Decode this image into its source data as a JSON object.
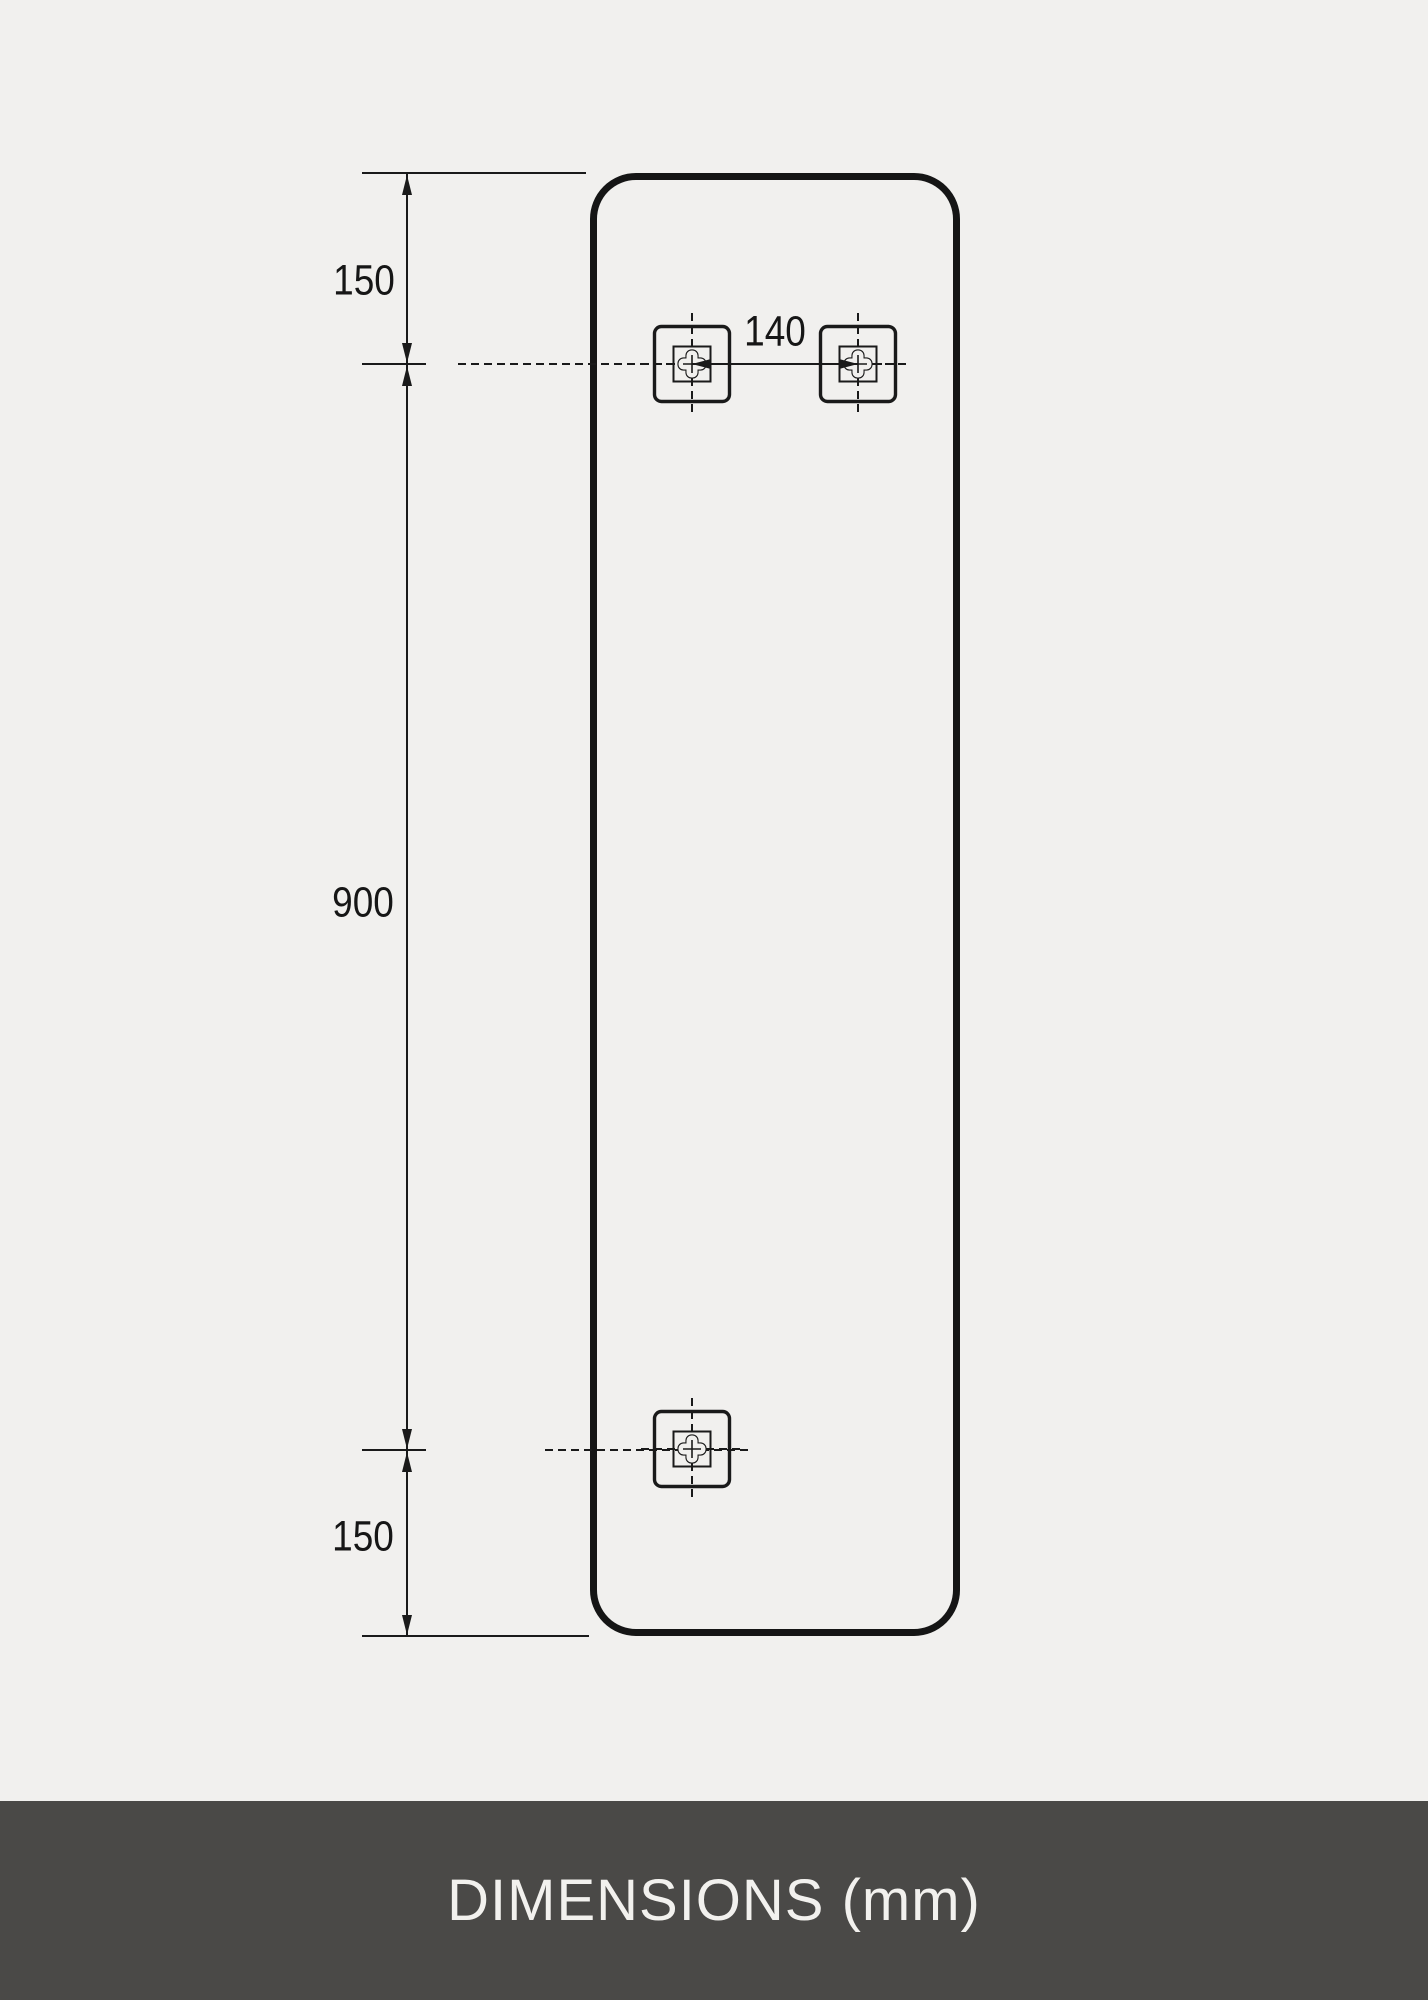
{
  "page": {
    "background_color": "#f1f0ee",
    "line_color": "#1a1a1a"
  },
  "diagram": {
    "dim_top_offset": "150",
    "dim_panel_length": "900",
    "dim_bottom_offset": "150",
    "dim_bracket_spacing": "140",
    "icons": {
      "mount_bracket": "mount-bracket-icon"
    }
  },
  "footer": {
    "label": "DIMENSIONS (mm)",
    "background_color": "#4a4947",
    "text_color": "#f2f1ee"
  }
}
